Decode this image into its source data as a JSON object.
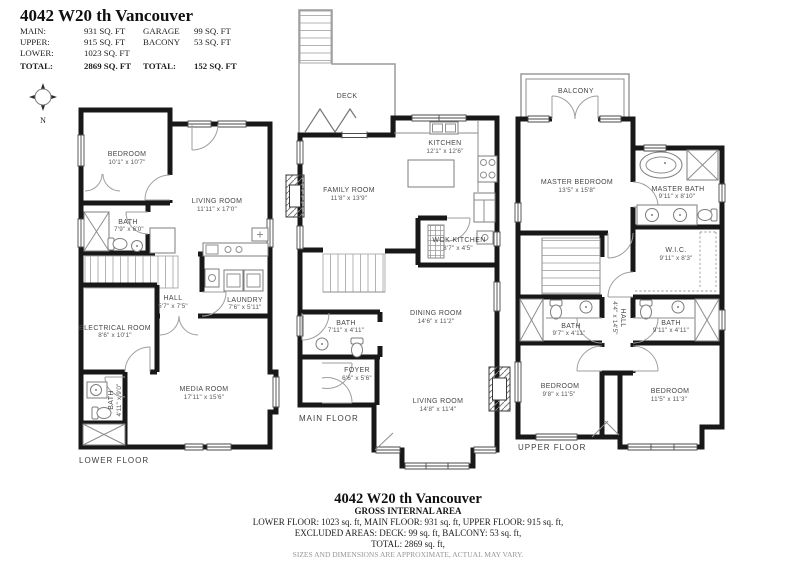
{
  "header": {
    "title": "4042 W20 th Vancouver",
    "rows": [
      {
        "l1": "MAIN:",
        "v1": "931 SQ. FT",
        "l2": "GARAGE",
        "v2": "99 SQ. FT"
      },
      {
        "l1": "UPPER:",
        "v1": "915 SQ. FT",
        "l2": "BACONY",
        "v2": "53 SQ. FT"
      },
      {
        "l1": "LOWER:",
        "v1": "1023 SQ. FT",
        "l2": "",
        "v2": ""
      },
      {
        "l1": "TOTAL:",
        "v1": "2869 SQ. FT",
        "l2": "TOTAL:",
        "v2": "152 SQ. FT"
      }
    ],
    "compass_n": "N"
  },
  "floors": {
    "lower": {
      "label": "LOWER FLOOR",
      "rooms": {
        "bedroom": {
          "name": "BEDROOM",
          "dims": "10'1\" x 10'7\""
        },
        "living": {
          "name": "LIVING ROOM",
          "dims": "11'11\" x 17'0\""
        },
        "bath": {
          "name": "BATH",
          "dims": "7'9\" x 6'0\""
        },
        "hall": {
          "name": "HALL",
          "dims": "5'7\" x 7'5\""
        },
        "laundry": {
          "name": "LAUNDRY",
          "dims": "7'6\" x 5'11\""
        },
        "electrical": {
          "name": "ELECTRICAL ROOM",
          "dims": "8'6\" x 10'1\""
        },
        "media": {
          "name": "MEDIA ROOM",
          "dims": "17'11\" x 15'6\""
        },
        "bath2": {
          "name": "BATH",
          "dims": "4'11\" x 9'0\""
        }
      }
    },
    "main": {
      "label": "MAIN FLOOR",
      "rooms": {
        "deck": {
          "name": "DECK"
        },
        "kitchen": {
          "name": "KITCHEN",
          "dims": "12'1\" x 12'6\""
        },
        "family": {
          "name": "FAMILY ROOM",
          "dims": "11'8\" x 13'9\""
        },
        "wok": {
          "name": "WOK KITCHEN",
          "dims": "8'7\" x 4'5\""
        },
        "bath": {
          "name": "BATH",
          "dims": "7'11\" x 4'11\""
        },
        "dining": {
          "name": "DINING ROOM",
          "dims": "14'6\" x 11'2\""
        },
        "foyer": {
          "name": "FOYER",
          "dims": "6'6\" x 5'6\""
        },
        "living": {
          "name": "LIVING ROOM",
          "dims": "14'8\" x 11'4\""
        }
      }
    },
    "upper": {
      "label": "UPPER FLOOR",
      "rooms": {
        "balcony": {
          "name": "BALCONY"
        },
        "master": {
          "name": "MASTER BEDROOM",
          "dims": "13'5\" x 15'8\""
        },
        "masterbath": {
          "name": "MASTER BATH",
          "dims": "9'11\" x 8'10\""
        },
        "wic": {
          "name": "W.I.C.",
          "dims": "9'11\" x 8'3\""
        },
        "bathL": {
          "name": "BATH",
          "dims": "9'7\" x 4'11\""
        },
        "bathR": {
          "name": "BATH",
          "dims": "9'11\" x 4'11\""
        },
        "hall": {
          "name": "HALL",
          "dims": "4'4\" x 14'5\""
        },
        "bedroomL": {
          "name": "BEDROOM",
          "dims": "9'8\" x 11'5\""
        },
        "bedroomR": {
          "name": "BEDROOM",
          "dims": "11'5\" x 11'3\""
        }
      }
    }
  },
  "footer": {
    "title": "4042 W20 th Vancouver",
    "subtitle": "GROSS INTERNAL AREA",
    "line1": "LOWER FLOOR: 1023 sq. ft,  MAIN FLOOR: 931 sq. ft, UPPER FLOOR: 915 sq. ft,",
    "line2": "EXCLUDED AREAS: DECK: 99 sq. ft, BALCONY: 53 sq. ft,",
    "line3": "TOTAL: 2869 sq. ft,",
    "disclaimer": "SIZES AND DIMENSIONS ARE APPROXIMATE, ACTUAL MAY VARY."
  },
  "colors": {
    "wall": "#181818",
    "background": "#ffffff",
    "label_text": "#474747"
  }
}
